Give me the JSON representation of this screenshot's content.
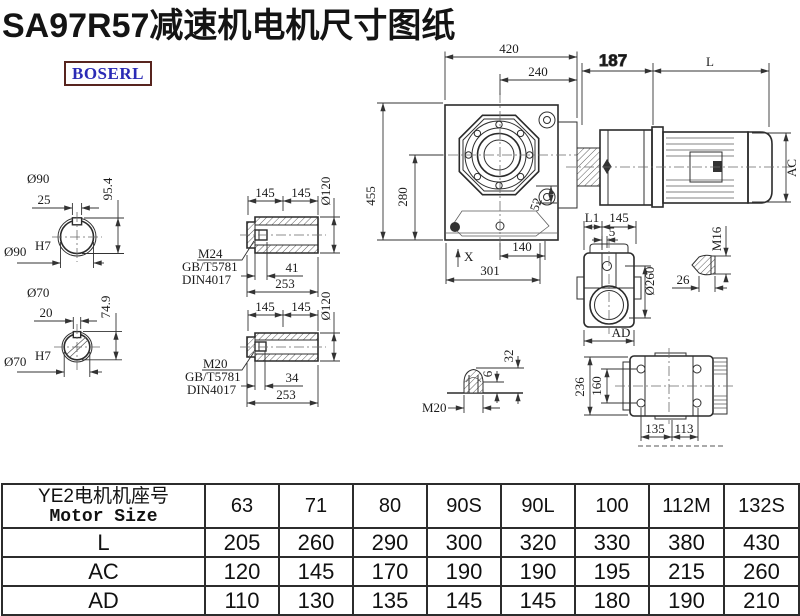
{
  "title": "SA97R57减速机电机尺寸图纸",
  "logo": {
    "text": "BOSERL"
  },
  "colors": {
    "title": "#141414",
    "logo_text": "#2a2ab5",
    "logo_border": "#57241e",
    "line": "#2f2f2f",
    "background": "#ffffff"
  },
  "dims": {
    "d420": "420",
    "d240": "240",
    "d187": "187",
    "L": "L",
    "AC": "AC",
    "d455": "455",
    "d280": "280",
    "d52": "52",
    "X": "X",
    "d140": "140",
    "d301": "301",
    "d90": "Ø90",
    "d25": "25",
    "d95_4": "95.4",
    "h7": "H7",
    "d70": "Ø70",
    "d20": "20",
    "d74_9": "74.9",
    "d145": "145",
    "d120": "Ø120",
    "m24": "M24",
    "m20": "M20",
    "gb": "GB/T5781",
    "din": "DIN4017",
    "d41": "41",
    "d34": "34",
    "d253": "253",
    "L1": "L1",
    "d5": "5",
    "d260": "Ø260",
    "AD": "AD",
    "m16": "M16",
    "d26": "26",
    "d6": "6",
    "d32": "32",
    "d236": "236",
    "d160": "160",
    "d135": "135",
    "d113": "113"
  },
  "table": {
    "header_cn": "YE2电机机座号",
    "header_en": "Motor Size",
    "columns": [
      "63",
      "71",
      "80",
      "90S",
      "90L",
      "100",
      "112M",
      "132S"
    ],
    "rows": [
      {
        "label": "L",
        "values": [
          "205",
          "260",
          "290",
          "300",
          "320",
          "330",
          "380",
          "430"
        ]
      },
      {
        "label": "AC",
        "values": [
          "120",
          "145",
          "170",
          "190",
          "190",
          "195",
          "215",
          "260"
        ]
      },
      {
        "label": "AD",
        "values": [
          "110",
          "130",
          "135",
          "145",
          "145",
          "180",
          "190",
          "210"
        ]
      }
    ]
  }
}
